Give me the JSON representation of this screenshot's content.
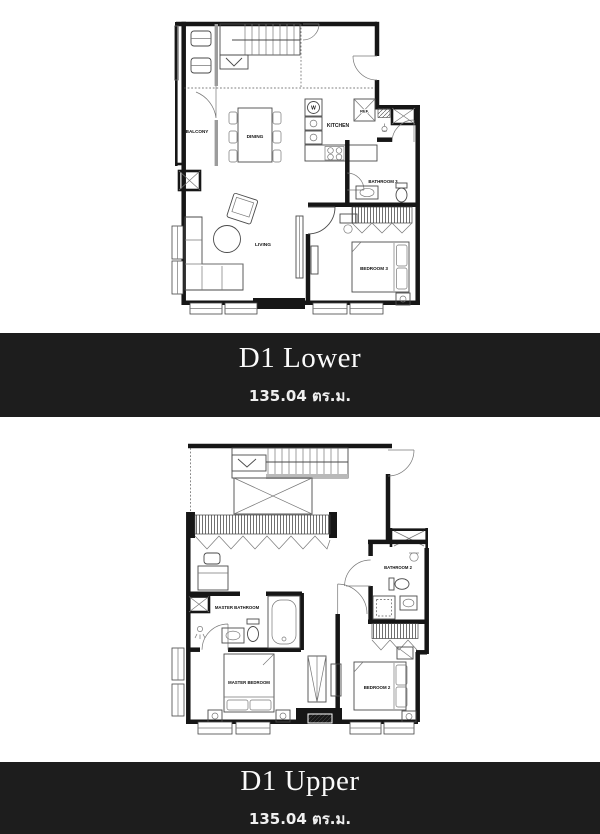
{
  "page": {
    "background_color": "#ffffff",
    "banner_color": "#1d1d1d",
    "banner_text_color": "#ffffff",
    "line_color": "#161616"
  },
  "banners": [
    {
      "title": "D1 Lower",
      "area": "135.04 ตร.ม."
    },
    {
      "title": "D1 Upper",
      "area": "135.04 ตร.ม."
    }
  ],
  "lower_plan": {
    "name": "D1 Lower floor plan",
    "labels": {
      "balcony": "BALCONY",
      "dining": "DINING",
      "kitchen": "KITCHEN",
      "ref": "REF.",
      "washer": "W",
      "living": "LIVING",
      "bathroom3": "BATHROOM 3",
      "bedroom3": "BEDROOM 3"
    }
  },
  "upper_plan": {
    "name": "D1 Upper floor plan",
    "labels": {
      "master_bathroom": "MASTER BATHROOM",
      "master_bedroom": "MASTER BEDROOM",
      "bedroom2": "BEDROOM 2",
      "bathroom2": "BATHROOM 2"
    }
  }
}
